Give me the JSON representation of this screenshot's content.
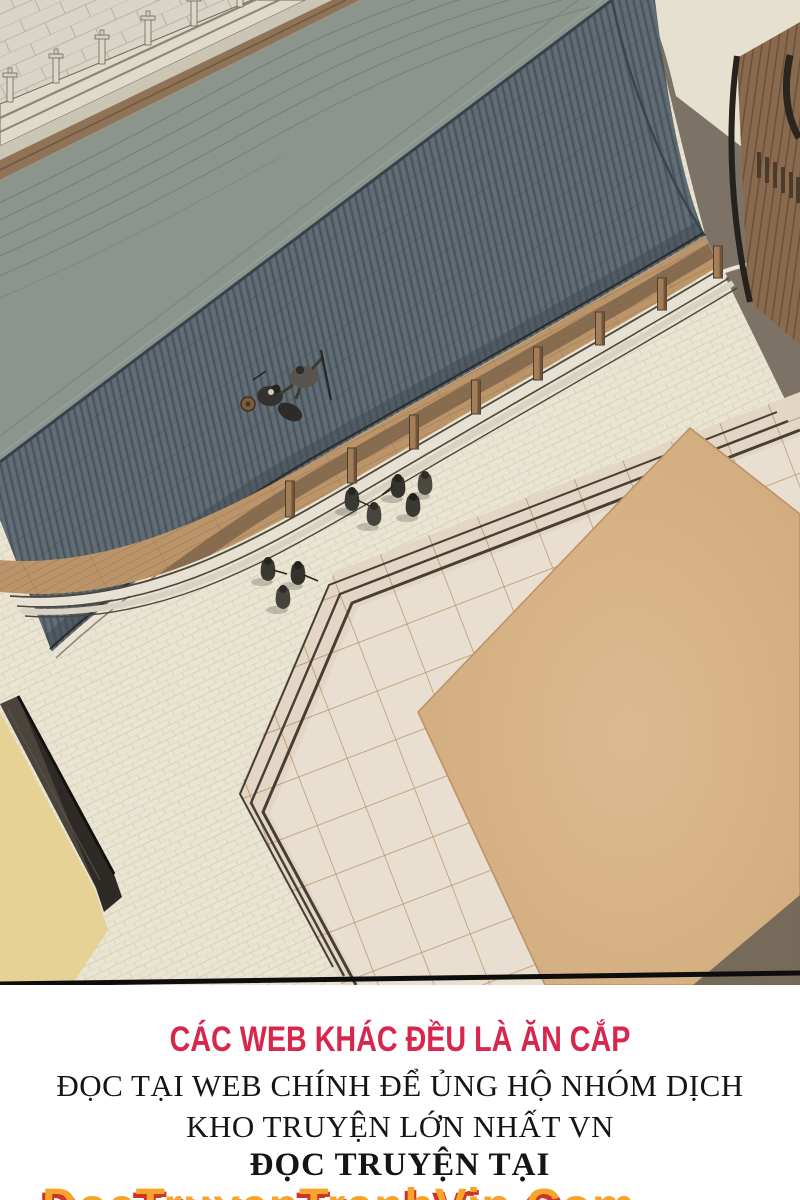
{
  "scene": {
    "description": "Aerial bird's-eye manhwa panel: long grey tiled roof of a traditional hall with fighters on it, wooden veranda with pillars, cream cobblestone courtyard with robed figures, raised sparring platform with tan sand arena, stone balustrade terrace at top-left, gate building and cast shadow at right, dark perimeter wall at bottom-left",
    "palette": {
      "roof_upper": "#8b948d",
      "roof_lower": "#5e6971",
      "roof_stripe": "#49545c",
      "ridge_line": "#39424a",
      "eave_fascia": "#e8e3d4",
      "courtyard": "#eae5d2",
      "pale_court": "#e5e1ce",
      "building_shadow": "#7c7266",
      "porch_wood": "#bb9469",
      "beam_wood": "#8f7357",
      "pillar_wood": "#a37e59",
      "balustrade_stone": "#e0dacb",
      "pavement": "#d9d5c6",
      "platform_tile": "#e9dfd0",
      "platform_joint": "#bb9268",
      "arena_sand": "#d7b286",
      "step_dark": "#463f35",
      "gate_wood": "#8a6a4e",
      "wall_dark": "#4a443c",
      "ground_yellow": "#e6d294",
      "figure_dark": "#3a3933",
      "panel_border": "#0d0d0d"
    }
  },
  "footer": {
    "warning": "CÁC WEB KHÁC ĐỀU LÀ ĂN CẮP",
    "support": "ĐỌC TẠI WEB CHÍNH ĐỂ ỦNG HỘ NHÓM DỊCH",
    "tagline": "KHO TRUYỆN LỚN NHẤT VN",
    "read_at": "ĐỌC TRUYỆN TẠI",
    "logo": "DocTruyenTranhVip.Com",
    "colors": {
      "warning_red": "#d8274d",
      "text_black": "#171412",
      "logo_orange": "#f6a42c",
      "logo_shadow_red": "#cf3526"
    }
  }
}
